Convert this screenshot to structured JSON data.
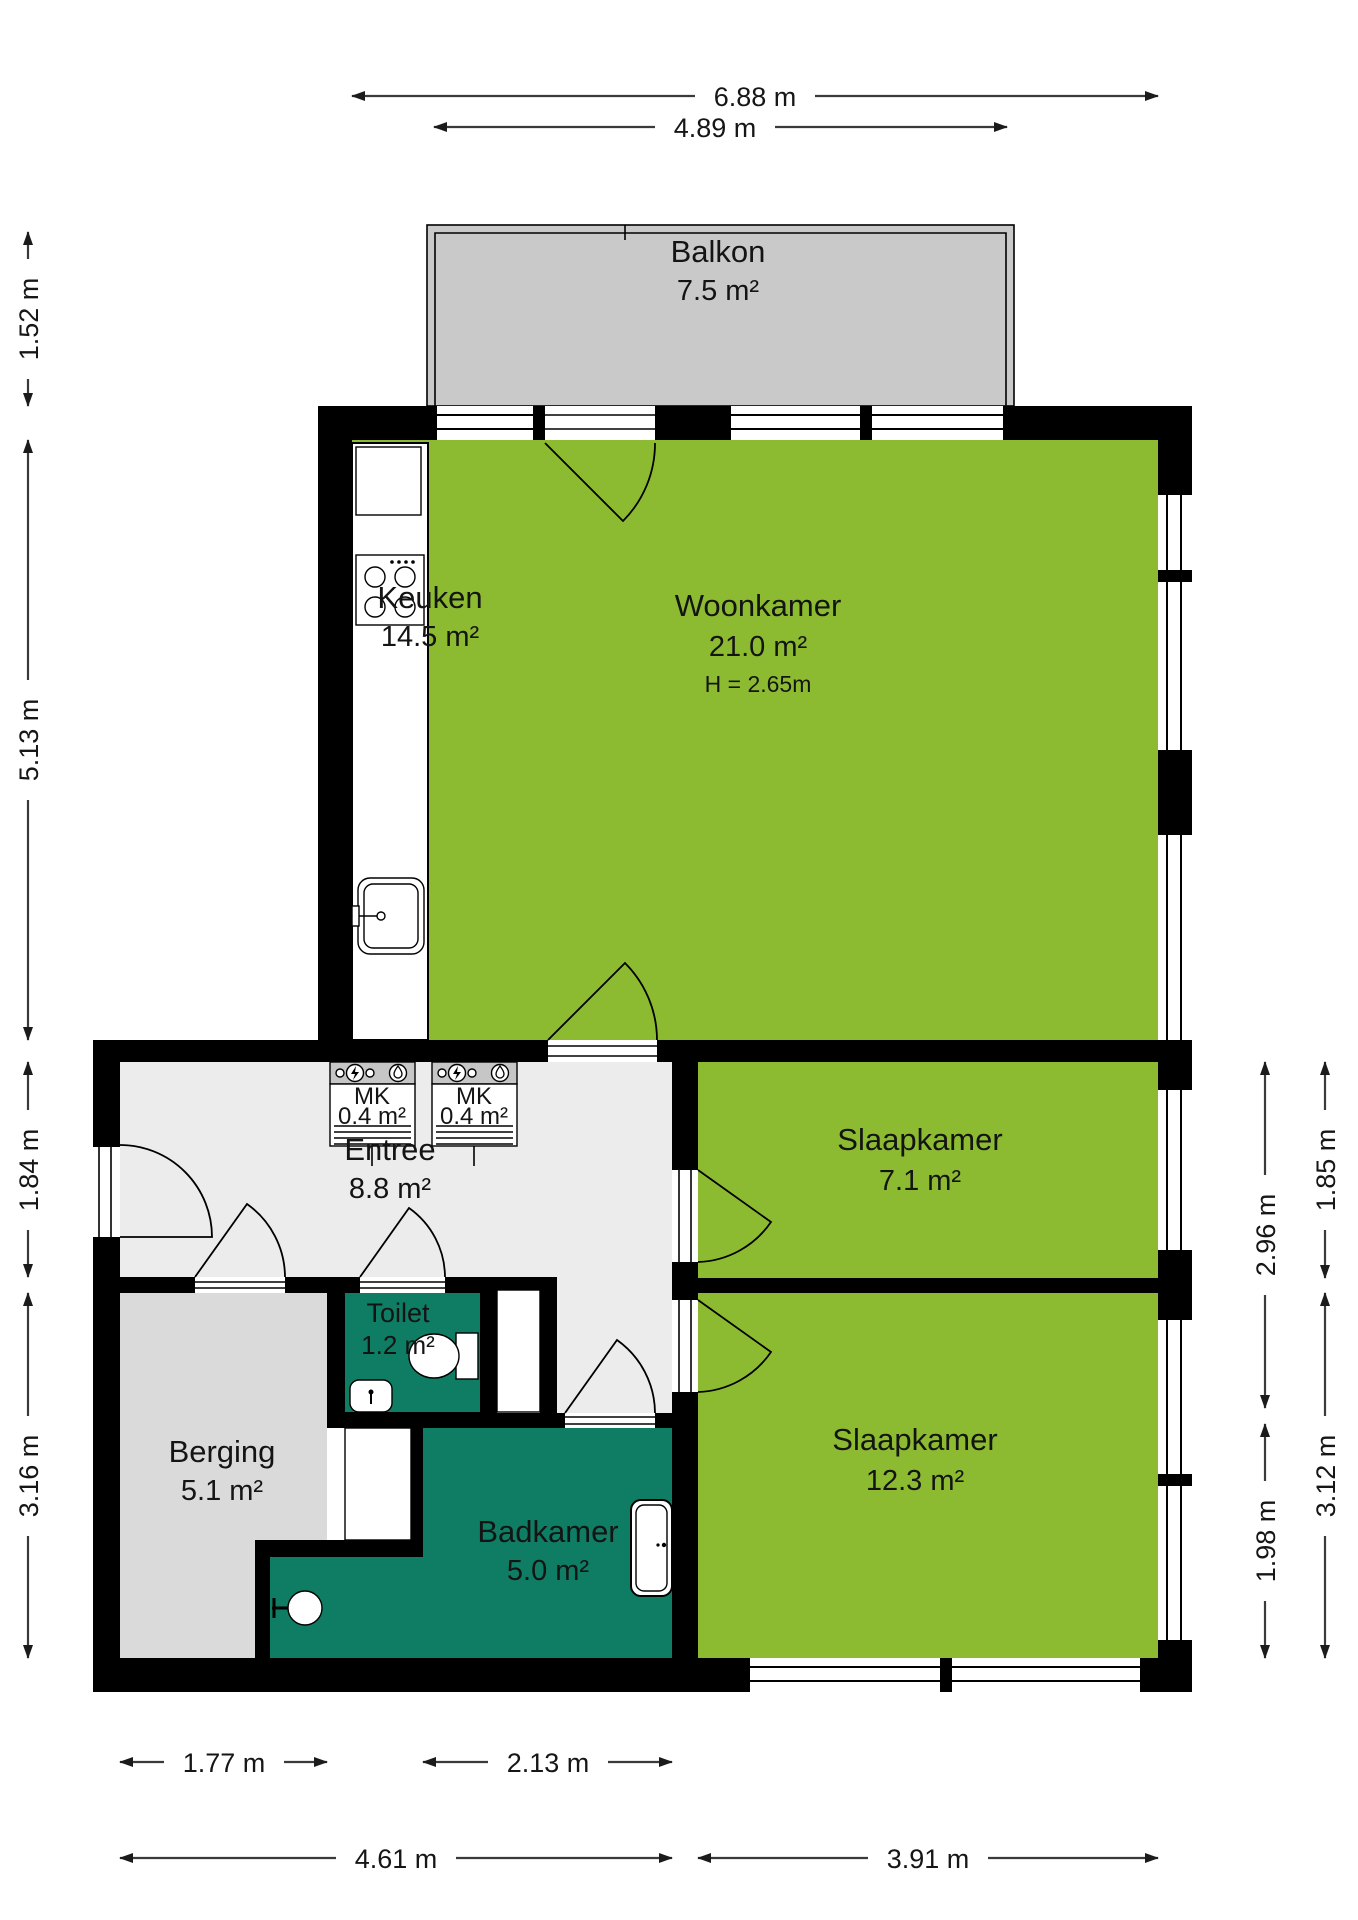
{
  "plan": {
    "rooms": {
      "balkon": {
        "name": "Balkon",
        "area": "7.5 m²"
      },
      "keuken": {
        "name": "Keuken",
        "area": "14.5 m²"
      },
      "woonkamer": {
        "name": "Woonkamer",
        "area": "21.0 m²",
        "ceiling": "H = 2.65m"
      },
      "slaapkamer_klein": {
        "name": "Slaapkamer",
        "area": "7.1 m²"
      },
      "slaapkamer_groot": {
        "name": "Slaapkamer",
        "area": "12.3 m²"
      },
      "entree": {
        "name": "Entree",
        "area": "8.8 m²"
      },
      "toilet": {
        "name": "Toilet",
        "area": "1.2 m²"
      },
      "berging": {
        "name": "Berging",
        "area": "5.1 m²"
      },
      "badkamer": {
        "name": "Badkamer",
        "area": "5.0 m²"
      },
      "meterkast_links": {
        "name": "MK",
        "area": "0.4 m²"
      },
      "meterkast_rechts": {
        "name": "MK",
        "area": "0.4 m²"
      }
    },
    "dimensions": {
      "top_total": "6.88 m",
      "top_balkon": "4.89 m",
      "left_balkon": "1.52 m",
      "left_upper": "5.13 m",
      "left_middle": "1.84 m",
      "left_lower": "3.16 m",
      "right_inner_upper": "2.96 m",
      "right_outer_upper": "1.85 m",
      "right_inner_lower": "1.98 m",
      "right_outer_lower": "3.12 m",
      "bottom_berging": "1.77 m",
      "bottom_badkamer": "2.13 m",
      "bottom_left_total": "4.61 m",
      "bottom_slaapkamer": "3.91 m"
    },
    "colors": {
      "living": "#8cbb31",
      "wet": "#0e7d64",
      "hall": "#ececec",
      "storage": "#dadada",
      "balcony": "#c9c9c9",
      "wall": "#000000"
    }
  }
}
